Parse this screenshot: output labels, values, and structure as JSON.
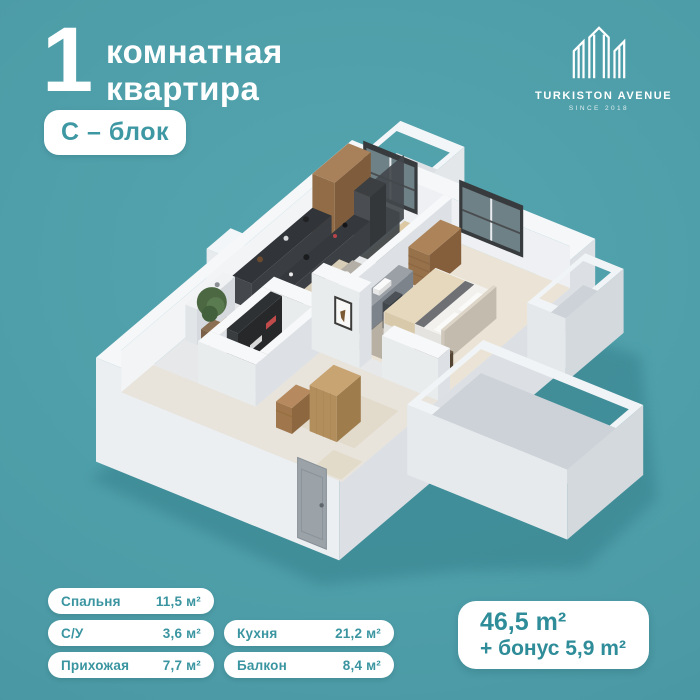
{
  "header": {
    "number": "1",
    "title_line1": "комнатная",
    "title_line2": "квартира",
    "block_badge": "С – блок"
  },
  "logo": {
    "name": "TURKISTON AVENUE",
    "since": "SINCE 2018",
    "icon": "building-monogram-icon"
  },
  "rooms": [
    {
      "label": "Спальня",
      "area": "11,5 м²"
    },
    {
      "label": "С/У",
      "area": "3,6 м²"
    },
    {
      "label": "Прихожая",
      "area": "7,7 м²"
    },
    {
      "label": "Кухня",
      "area": "21,2 м²"
    },
    {
      "label": "Балкон",
      "area": "8,4 м²"
    }
  ],
  "total": {
    "area": "46,5 m²",
    "bonus": "+ бонус 5,9 m²"
  },
  "floorplan": {
    "description": "3D isometric cutaway floor plan of a 1-room apartment, C-block",
    "colors": {
      "background": "#4d9da8",
      "shadow": "#3a8792",
      "walls": "#f5f7f9",
      "accent_teal": "#3a95a0",
      "card_text": "#2f8d99",
      "wood": "#ab8157",
      "counter_dark": "#35383c"
    }
  }
}
